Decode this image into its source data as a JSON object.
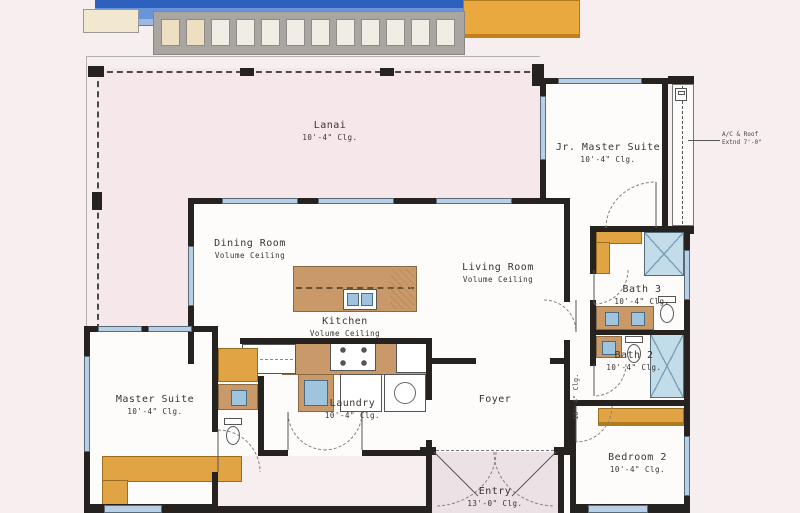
{
  "document": {
    "type": "residential-floor-plan"
  },
  "rooms": [
    {
      "id": "lanai",
      "name": "Lanai",
      "ceiling": "10'-4\" Clg."
    },
    {
      "id": "jr-master-suite",
      "name": "Jr. Master Suite",
      "ceiling": "10'-4\" Clg."
    },
    {
      "id": "dining-room",
      "name": "Dining Room",
      "ceiling": "Volume Ceiling"
    },
    {
      "id": "living-room",
      "name": "Living Room",
      "ceiling": "Volume Ceiling"
    },
    {
      "id": "kitchen",
      "name": "Kitchen",
      "ceiling": "Volume Ceiling"
    },
    {
      "id": "bath-3",
      "name": "Bath 3",
      "ceiling": "10'-4\" Clg."
    },
    {
      "id": "bath-2",
      "name": "Bath 2",
      "ceiling": "10'-4\" Clg."
    },
    {
      "id": "master-suite",
      "name": "Master Suite",
      "ceiling": "10'-4\" Clg."
    },
    {
      "id": "laundry",
      "name": "Laundry",
      "ceiling": "10'-4\" Clg."
    },
    {
      "id": "foyer",
      "name": "Foyer",
      "ceiling": ""
    },
    {
      "id": "entry",
      "name": "Entry",
      "ceiling": "13'-0\" Clg."
    },
    {
      "id": "bedroom-2",
      "name": "Bedroom 2",
      "ceiling": "10'-4\" Clg."
    }
  ],
  "annotations": {
    "roof_note_line1": "A/C & Roof",
    "roof_note_line2": "Extnd 7'-0\"",
    "hall_ceiling": "10'-4\" Clg."
  },
  "pool": {
    "paver_count": 12
  },
  "colors": {
    "page_bg": "#f7eef0",
    "pool_water": "#5b8fd9",
    "pool_edge": "#2e61bd",
    "deck": "#e9a93e",
    "cabinet": "#c9996a",
    "built_in": "#e0a445",
    "window": "#b9cfe6",
    "wall": "#26221f",
    "shower": "#c2dcea",
    "lanai_floor": "#f6e8ea",
    "entry_floor": "#ece1e5"
  }
}
